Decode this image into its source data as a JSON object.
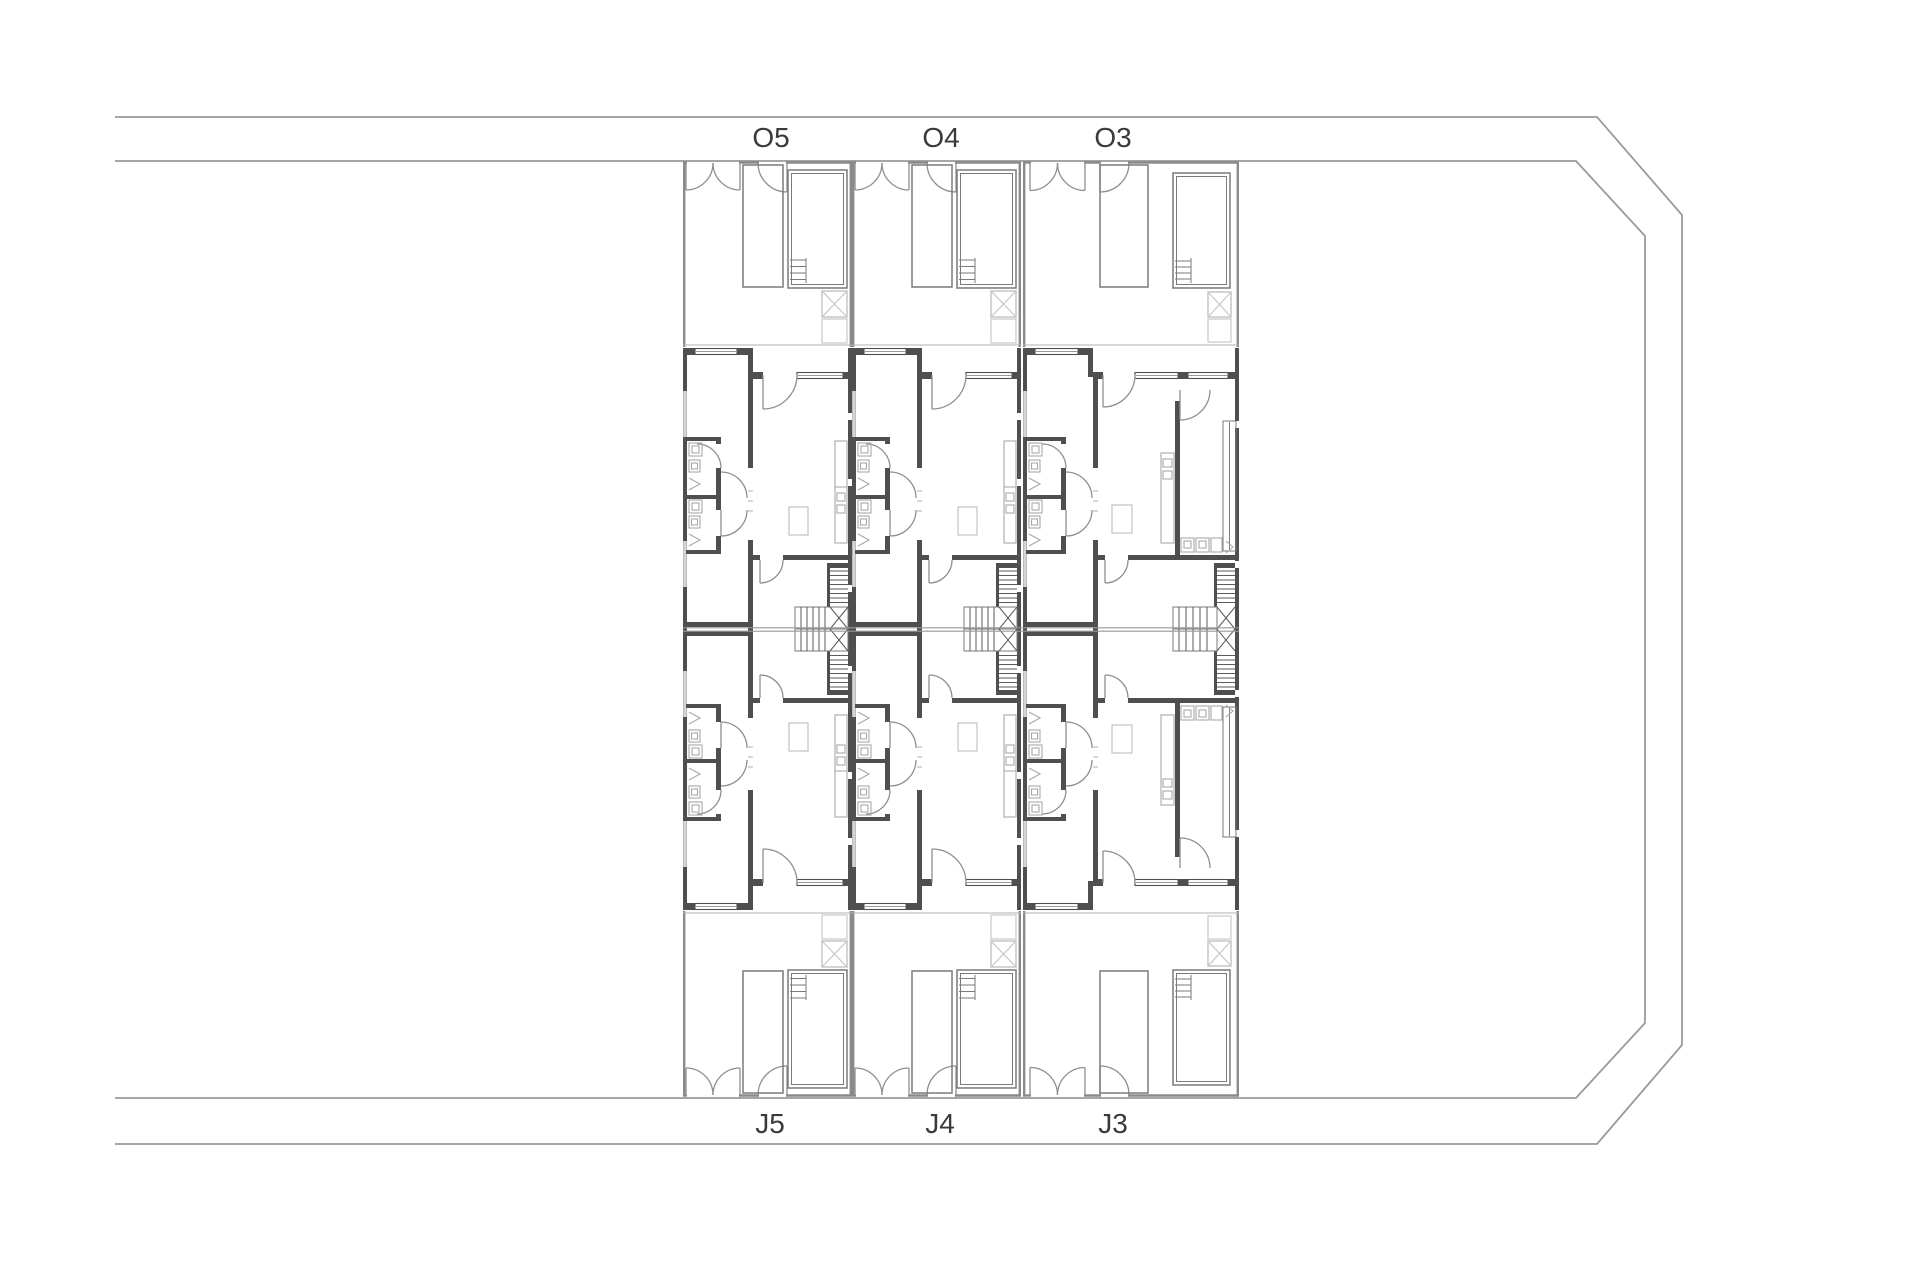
{
  "plan": {
    "unit_labels_top": [
      "O5",
      "O4",
      "O3"
    ],
    "unit_labels_bottom": [
      "J5",
      "J4",
      "J3"
    ],
    "colors": {
      "background": "#ffffff",
      "boundary_line": "#9a9a9a",
      "wall_dark": "#4f4f4f",
      "wall_medium": "#8a8a8a",
      "detail_light": "#b5b5b5",
      "label_text": "#3a3a3a"
    }
  }
}
